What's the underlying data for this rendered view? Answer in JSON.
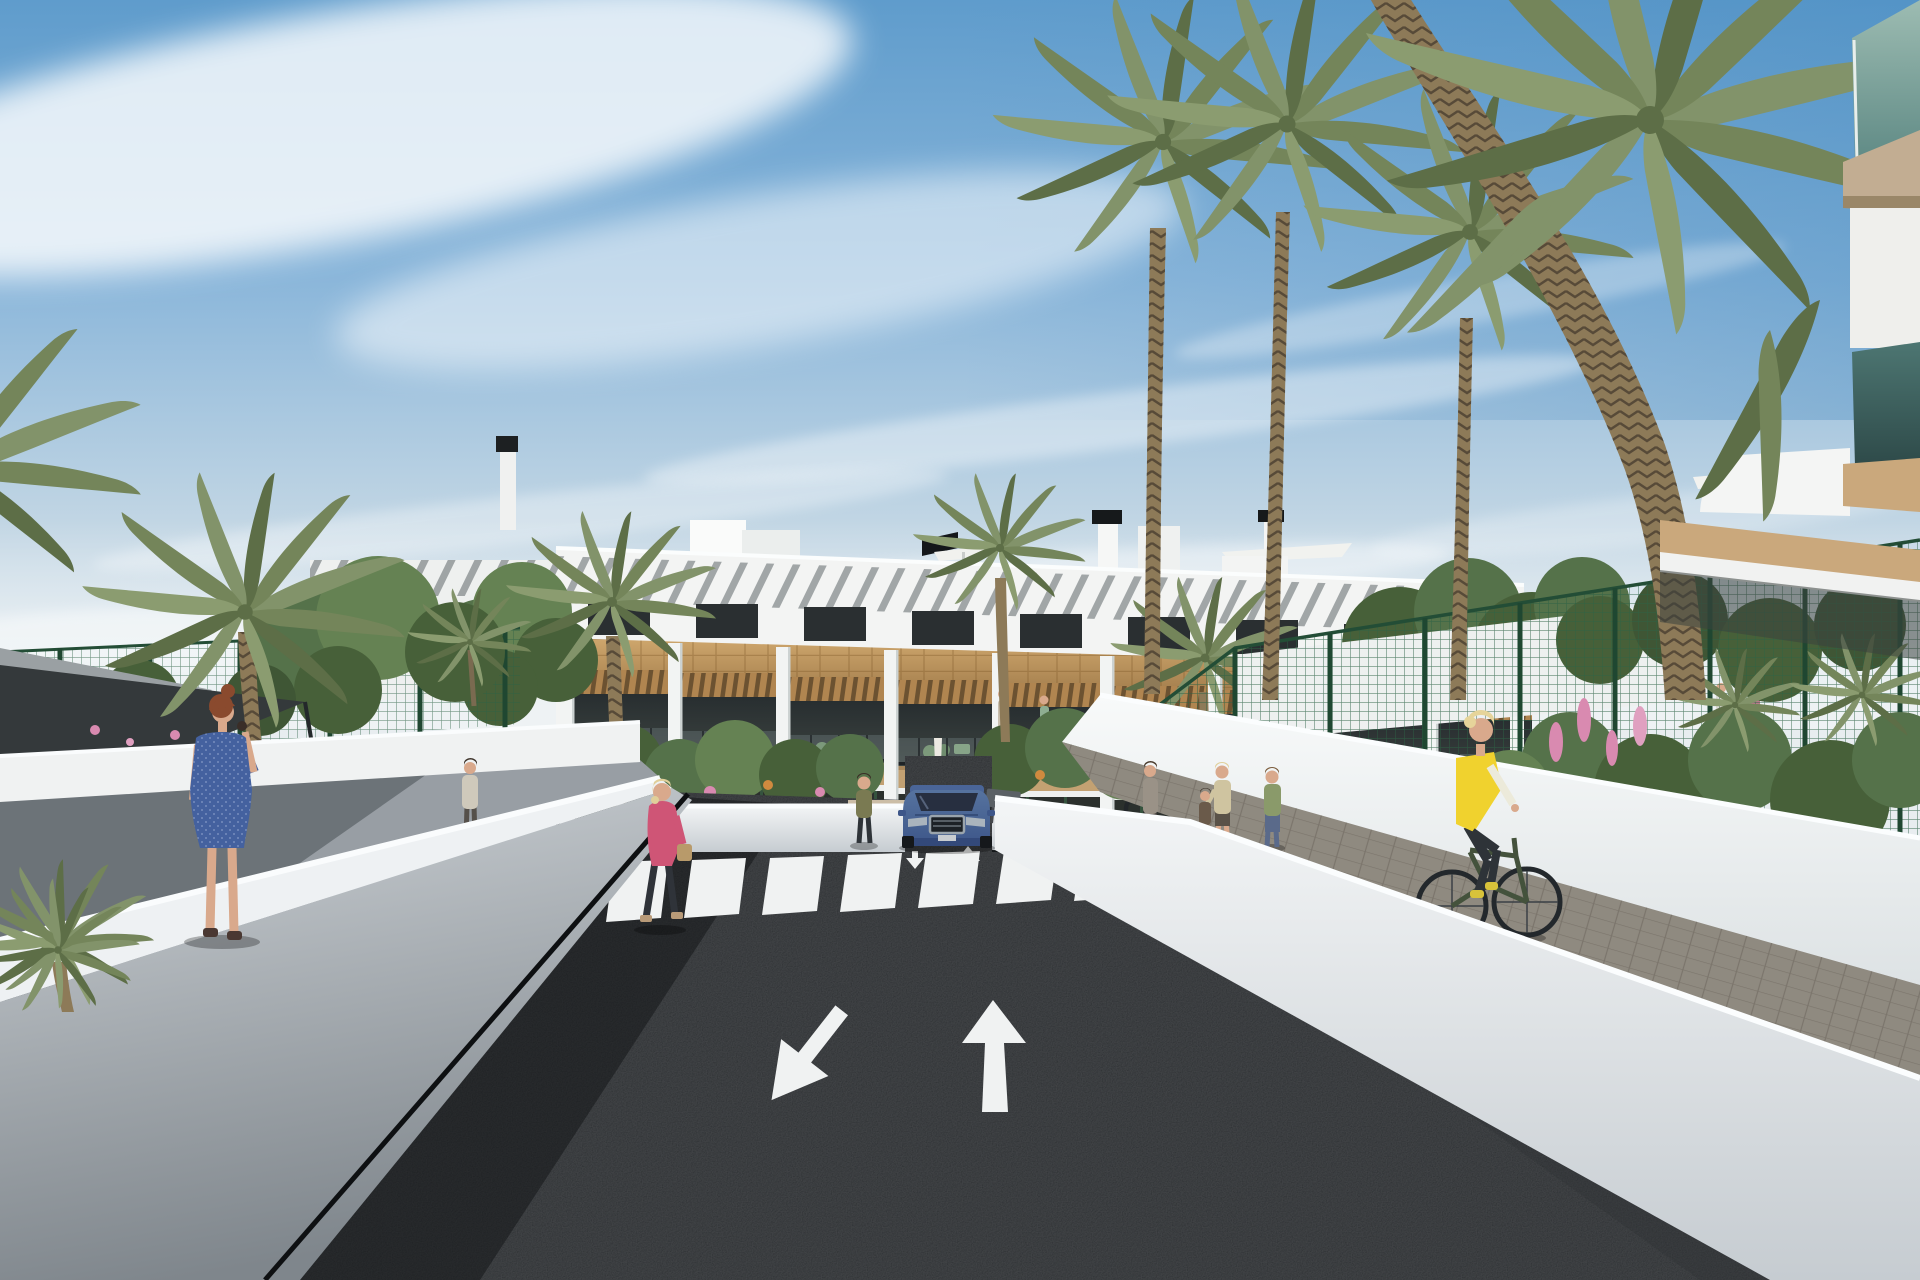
{
  "meta": {
    "kind": "architectural-exterior-render",
    "subject": "3D visualization of a modern white three-storey apartment complex with palm trees, a two-way entrance road with painted arrows, zebra crosswalk, pedestrians, a cyclist and a blue SUV leaving the underground garage",
    "canvas": "1920x1280"
  },
  "palette": {
    "sky_top": "#5f9ccc",
    "sky_mid": "#8ab6da",
    "sky_horizon": "#e8edf0",
    "cloud": "#ffffff",
    "building_wall": "#f3f4f3",
    "wood_cladding": "#c09a62",
    "window_glass": "#2a2f31",
    "pergola_shadow": "#464e52",
    "asphalt": "#232629",
    "road_marking": "#f0f2f2",
    "sidewalk": "#989ea4",
    "white_wall": "#eff1f2",
    "paver_path": "#8f8a80",
    "mesh_fence": "#2d6245",
    "fence_post": "#1f4731",
    "shade_sail": "#34393b",
    "palm_frond": "#74855a",
    "palm_trunk": "#8d7a58",
    "leafy_tree": "#55724a",
    "flower_pink": "#d98ab0",
    "flower_orange": "#d08a3f",
    "car_body": "#4f6dac",
    "car_glass": "#272f40",
    "vest_yellow": "#f0d22e",
    "bike_green": "#44523c",
    "dress_blue": "#44619f",
    "jacket_pink": "#cf5576",
    "skin": "#d9a98c",
    "balcony_glass": "#6d9a92"
  },
  "road": {
    "lanes": 2,
    "markings": [
      "left lane arrow pointing down-left (toward viewer)",
      "right lane arrow pointing up (away)",
      "zebra crosswalk with 8 stripes",
      "small exit arrow near ramp",
      "small entry arrow near ramp"
    ]
  },
  "building": {
    "floors": 3,
    "features": [
      "rooftop terraces with white parasols",
      "black solar panels and chimney caps",
      "slatted pergola shading the upper wall",
      "wood-clad band between floors",
      "glazed balconies with wood pergolas and green furniture",
      "ground floor terraces behind white planter walls"
    ]
  },
  "figures": [
    {
      "name": "woman-blue-dress",
      "pose": "standing on the left sidewalk holding a phone to her ear",
      "hair": "#8a4a2e"
    },
    {
      "name": "woman-pink-jacket",
      "pose": "walking left near the entrance",
      "hair": "#e0cf9a"
    },
    {
      "name": "woman-olive-top",
      "pose": "standing on the entrance path"
    },
    {
      "name": "pedestrian-gray",
      "pose": "walking away on the far left path"
    },
    {
      "name": "mother-and-child",
      "pose": "standing on the right paver path"
    },
    {
      "name": "woman-green-top",
      "pose": "standing on the right paver path"
    },
    {
      "name": "person-at-bike-racks",
      "pose": "standing beside parked bicycles"
    },
    {
      "name": "cyclist",
      "pose": "riding toward viewer on right paver path"
    },
    {
      "name": "balcony-residents",
      "count": 4
    }
  ],
  "vehicles": [
    {
      "name": "blue-suv",
      "position": "exiting garage ramp at complex entrance"
    }
  ],
  "landscape": {
    "palm_count": 12,
    "leafy_trees": 7,
    "shade_sail": true,
    "green_mesh_fences": 2,
    "bike_racks": 9,
    "flowers": [
      "pink lupines",
      "orange shrub flowers",
      "pink hedge blossoms"
    ]
  }
}
